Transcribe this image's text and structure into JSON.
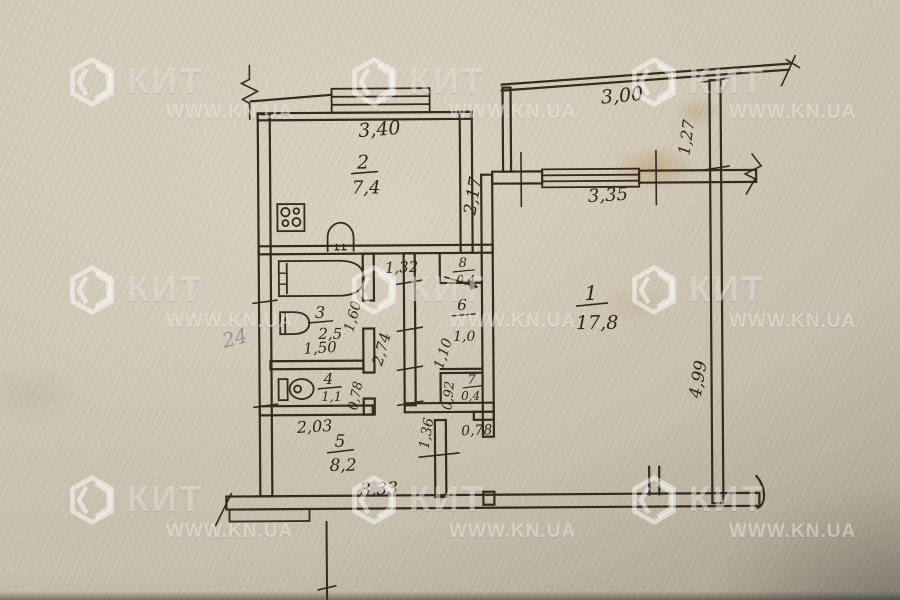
{
  "watermark": {
    "brand": "КИТ",
    "site": "WWW.KN.UA"
  },
  "plan": {
    "handwritten_note": "24",
    "rooms": {
      "r1": {
        "number": "1",
        "area": "17,8"
      },
      "r2": {
        "number": "2",
        "area": "7,4"
      },
      "r3": {
        "number": "3",
        "area": "2,5"
      },
      "r4": {
        "number": "4",
        "area": "1,1"
      },
      "r5": {
        "number": "5",
        "area": "8,2"
      },
      "r6": {
        "number": "6",
        "area": "1,0"
      },
      "r7": {
        "number": "7",
        "area": "0,4"
      },
      "r8": {
        "number": "8",
        "area": "0,4"
      }
    },
    "dims": {
      "kitchen_width": "3,40",
      "kitchen_depth": "2,17",
      "balcony_width": "3,00",
      "balcony_depth": "1,27",
      "room1_window": "3,35",
      "room1_depth": "4,99",
      "corridor_top": "1,32",
      "bath_width": "1,50",
      "bath_depth": "1,60",
      "corridor_length": "2,74",
      "wc_depth": "0,78",
      "closet6_depth": "1,10",
      "closet7_depth": "0,92",
      "passage_depth": "1,36",
      "hall_width": "2,03",
      "door_width": "0,78",
      "hall_bottom": "3,33"
    }
  }
}
